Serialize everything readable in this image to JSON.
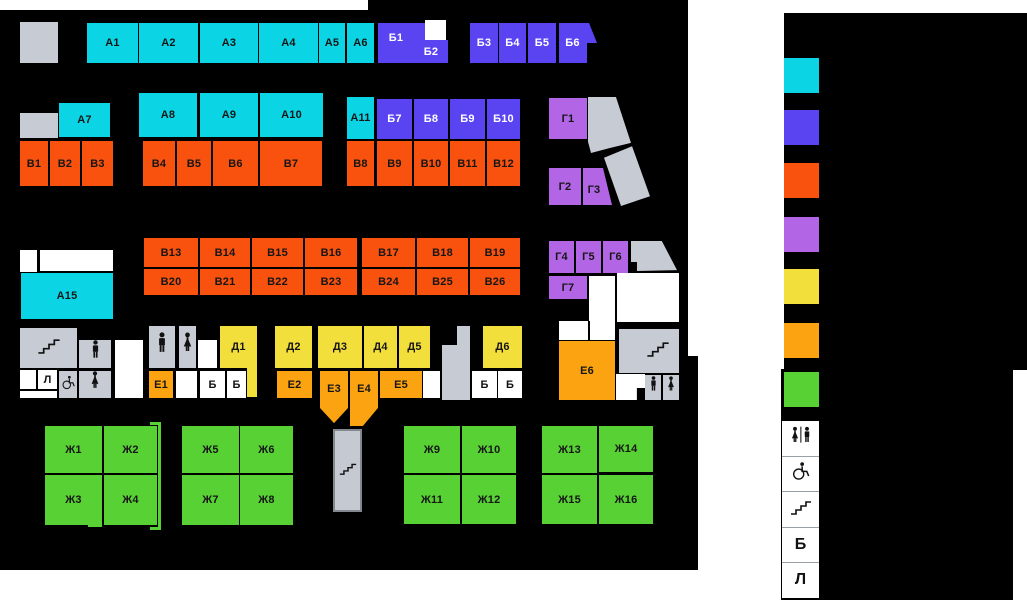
{
  "units": [
    {
      "label": "А1"
    },
    {
      "label": "А2"
    },
    {
      "label": "А3"
    },
    {
      "label": "А4"
    },
    {
      "label": "А5"
    },
    {
      "label": "А6"
    },
    {
      "label": "А7"
    },
    {
      "label": "А8"
    },
    {
      "label": "А9"
    },
    {
      "label": "А10"
    },
    {
      "label": "А11"
    },
    {
      "label": "А15"
    },
    {
      "label": "Б1"
    },
    {
      "label": "Б2"
    },
    {
      "label": "Б3"
    },
    {
      "label": "Б4"
    },
    {
      "label": "Б5"
    },
    {
      "label": "Б6"
    },
    {
      "label": "Б7"
    },
    {
      "label": "Б8"
    },
    {
      "label": "Б9"
    },
    {
      "label": "Б10"
    },
    {
      "label": "В1"
    },
    {
      "label": "В2"
    },
    {
      "label": "В3"
    },
    {
      "label": "В4"
    },
    {
      "label": "В5"
    },
    {
      "label": "В6"
    },
    {
      "label": "В7"
    },
    {
      "label": "В8"
    },
    {
      "label": "В9"
    },
    {
      "label": "В10"
    },
    {
      "label": "В11"
    },
    {
      "label": "В12"
    },
    {
      "label": "В13"
    },
    {
      "label": "В14"
    },
    {
      "label": "В15"
    },
    {
      "label": "В16"
    },
    {
      "label": "В17"
    },
    {
      "label": "В18"
    },
    {
      "label": "В19"
    },
    {
      "label": "В20"
    },
    {
      "label": "В21"
    },
    {
      "label": "В22"
    },
    {
      "label": "В23"
    },
    {
      "label": "В24"
    },
    {
      "label": "В25"
    },
    {
      "label": "В26"
    },
    {
      "label": "Г1"
    },
    {
      "label": "Г2"
    },
    {
      "label": "Г3"
    },
    {
      "label": "Г4"
    },
    {
      "label": "Г5"
    },
    {
      "label": "Г6"
    },
    {
      "label": "Г7"
    },
    {
      "label": "Д1"
    },
    {
      "label": "Д2"
    },
    {
      "label": "Д3"
    },
    {
      "label": "Д4"
    },
    {
      "label": "Д5"
    },
    {
      "label": "Д6"
    },
    {
      "label": "Е1"
    },
    {
      "label": "Е2"
    },
    {
      "label": "Е3"
    },
    {
      "label": "Е4"
    },
    {
      "label": "Е5"
    },
    {
      "label": "Е6"
    },
    {
      "label": "Ж1"
    },
    {
      "label": "Ж2"
    },
    {
      "label": "Ж3"
    },
    {
      "label": "Ж4"
    },
    {
      "label": "Ж5"
    },
    {
      "label": "Ж6"
    },
    {
      "label": "Ж7"
    },
    {
      "label": "Ж8"
    },
    {
      "label": "Ж9"
    },
    {
      "label": "Ж10"
    },
    {
      "label": "Ж11"
    },
    {
      "label": "Ж12"
    },
    {
      "label": "Ж13"
    },
    {
      "label": "Ж14"
    },
    {
      "label": "Ж15"
    },
    {
      "label": "Ж16"
    }
  ],
  "service": {
    "atm_label": "Б",
    "lift_label": "Л"
  },
  "legend": {
    "zone_swatches": [
      {
        "name": "zone-a",
        "color": "#0BD5E4"
      },
      {
        "name": "zone-b",
        "color": "#5A44F2"
      },
      {
        "name": "zone-v",
        "color": "#F8520E"
      },
      {
        "name": "zone-g",
        "color": "#B265E5"
      },
      {
        "name": "zone-d",
        "color": "#F3DF3B"
      },
      {
        "name": "zone-e",
        "color": "#FCA312"
      },
      {
        "name": "zone-zh",
        "color": "#57D133"
      }
    ],
    "facility_rows": [
      {
        "icon": "toilets"
      },
      {
        "icon": "wheelchair"
      },
      {
        "icon": "stairs"
      },
      {
        "letter": "Б"
      },
      {
        "letter": "Л"
      }
    ]
  },
  "colors": {
    "map_background": "#000000",
    "corridor_gray": "#C7CBD4",
    "page_background": "#FFFFFF"
  }
}
